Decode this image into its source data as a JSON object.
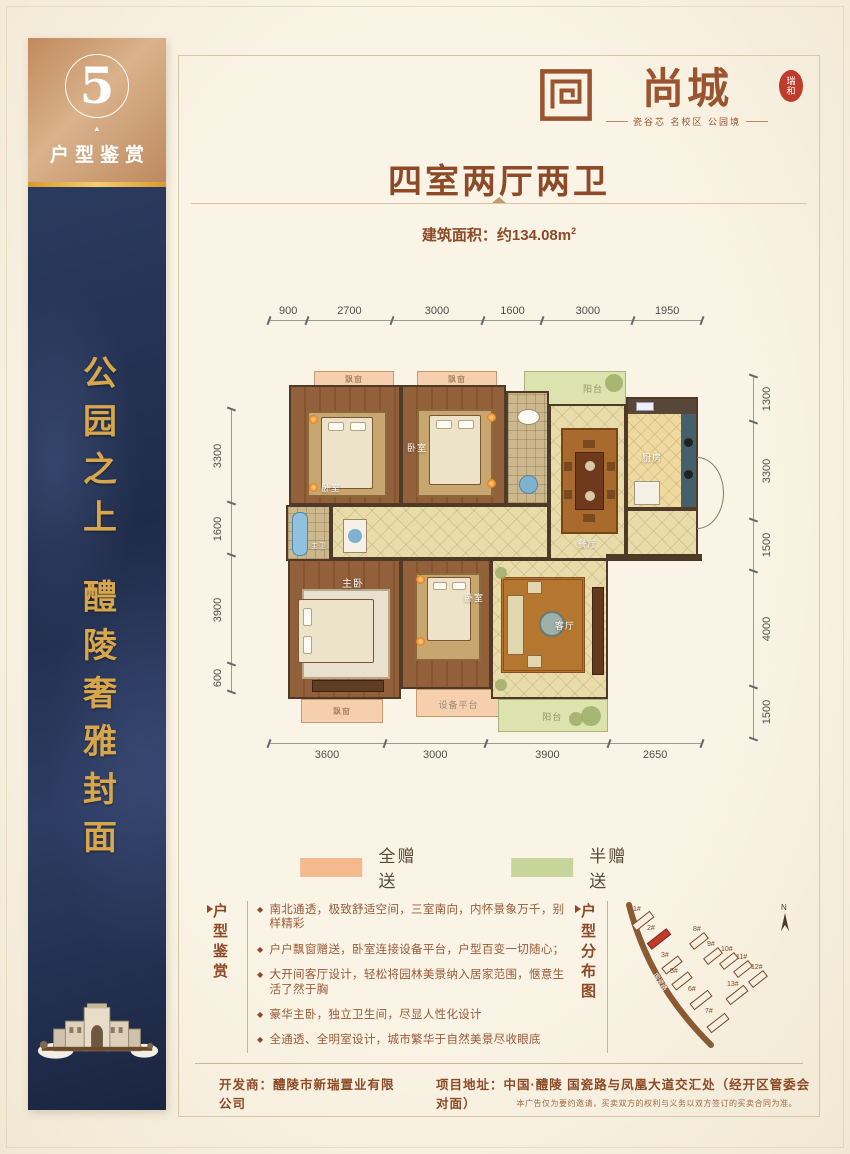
{
  "sidebar": {
    "number": "5",
    "tab_label": "户型鉴赏",
    "slogan_top": "公园之上",
    "slogan_bottom": "醴陵奢雅封面"
  },
  "logo": {
    "name": "尚城",
    "seal": "瑞和",
    "tagline": "瓷谷芯 名校区 公园境"
  },
  "header": {
    "title": "四室两厅两卫",
    "area_text": "建筑面积：约134.08m",
    "area_sup": "2"
  },
  "dims": {
    "top": [
      900,
      2700,
      3000,
      1600,
      3000,
      1950
    ],
    "bottom": [
      3600,
      3000,
      3900,
      2650
    ],
    "left": [
      3300,
      1600,
      3900,
      600
    ],
    "right": [
      1300,
      3300,
      1500,
      4000,
      1500
    ]
  },
  "plan": {
    "rooms": {
      "bay": "飘窗",
      "balcony": "阳台",
      "bedroom": "卧室",
      "master_bedroom": "主卧",
      "master_bath": "主卫",
      "dining": "餐厅",
      "kitchen": "厨房",
      "living": "客厅",
      "equipment": "设备平台"
    }
  },
  "legend": {
    "full_label": "全赠送",
    "full_color": "#f5b98e",
    "half_label": "半赠送",
    "half_color": "#c6d69b"
  },
  "features": {
    "side_label": "户型鉴赏",
    "items": [
      "南北通透，极致舒适空间，三室南向，内怀景象万千，别样精彩",
      "户户飘窗赠送，卧室连接设备平台，户型百变一切随心；",
      "大开间客厅设计，轻松将园林美景纳入居家范围，惬意生活了然于胸",
      "豪华主卧，独立卫生间，尽显人性化设计",
      "全通透、全明室设计，城市繁华于自然美景尽收眼底"
    ]
  },
  "distribution": {
    "side_label": "户型分布图",
    "road_label": "国瓷路",
    "compass": "N",
    "highlighted": "2#",
    "buildings": [
      "1#",
      "2#",
      "3#",
      "5#",
      "6#",
      "7#",
      "8#",
      "9#",
      "10#",
      "11#",
      "12#",
      "13#"
    ]
  },
  "footer": {
    "developer": "开发商：醴陵市新瑞置业有限公司",
    "address": "项目地址：中国·醴陵 国瓷路与凤凰大道交汇处（经开区管委会对面）",
    "disclaimer": "本广告仅为要约邀请，买卖双方的权利与义务以双方签订的买卖合同为准。"
  },
  "colors": {
    "accent": "#8e4a28",
    "gold": "#d8a74c",
    "navy": "#24324f",
    "bronze": "#c6916a",
    "highlight_red": "#c03b2b"
  }
}
